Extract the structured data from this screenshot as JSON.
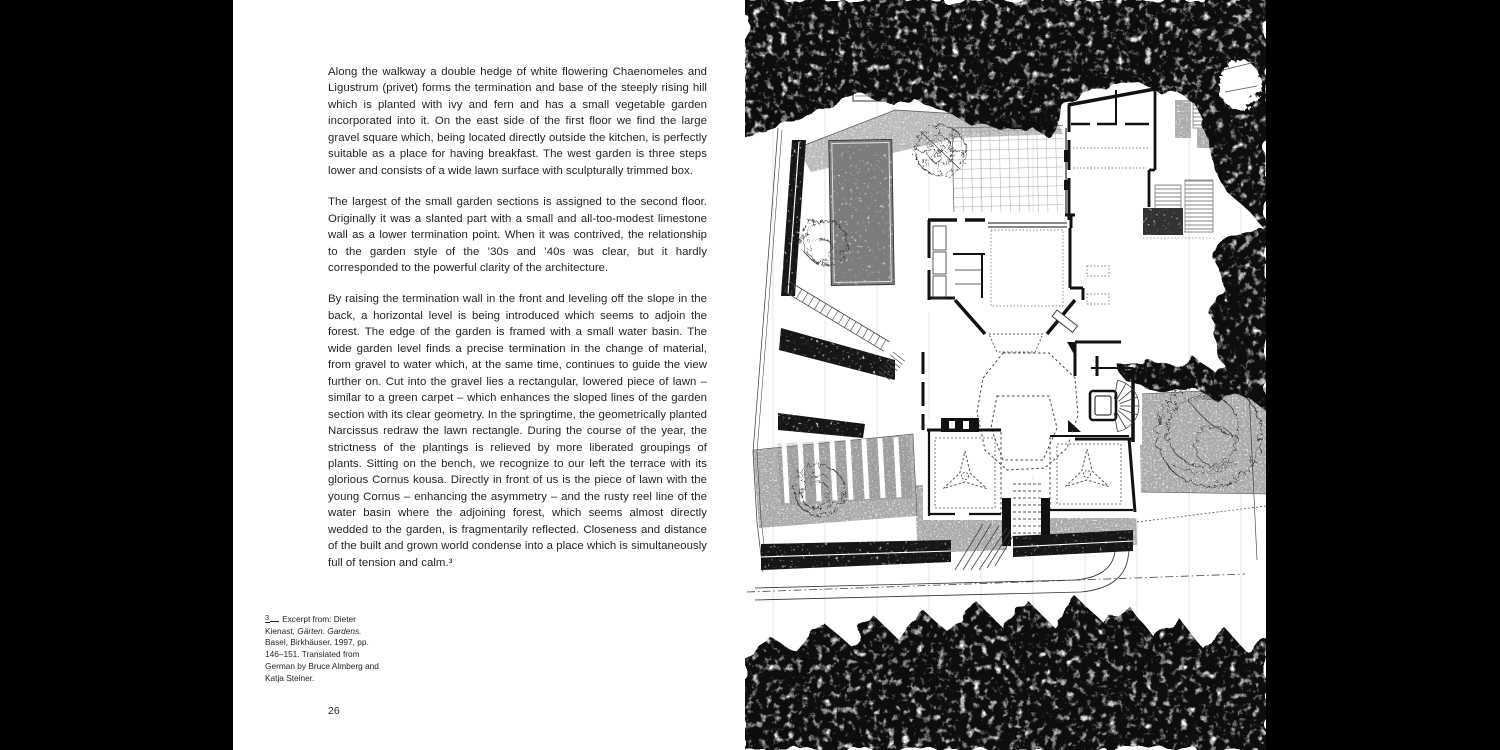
{
  "colors": {
    "background": "#000000",
    "paper": "#ffffff",
    "ink": "#242424"
  },
  "left_page": {
    "paragraphs": [
      "Along the walkway a double hedge of white flowering Chaenomeles and Ligustrum (privet) forms the termination and base of the steeply rising hill which is planted with ivy and fern and has a small vegetable garden incorporated into it. On the east side of the first floor we find the large gravel square which, being located directly outside the kitchen, is perfectly suitable as a place for having breakfast. The west garden is three steps lower and consists of a wide lawn surface with sculpturally trimmed box.",
      "The largest of the small garden sections is assigned to the second floor. Originally it was a slanted part with a small and all-too-modest limestone wall as a lower termination point. When it was contrived, the relationship to the garden style of the ’30s and ’40s was clear, but it hardly corresponded to the powerful clarity of the architecture.",
      "By raising the termination wall in the front and leveling off the slope in the back, a horizontal level is being introduced which seems to adjoin the forest. The edge of the garden is framed with a small water basin. The wide garden level finds a precise termination in the change of material, from gravel to water which, at the same time, continues to guide the view further on. Cut into the gravel lies a rectangular, lowered piece of lawn – similar to a green carpet – which enhances the sloped lines of the garden section with its clear geometry. In the springtime, the geometrically planted Narcissus redraw the lawn rectangle. During the course of the year, the strictness of the plantings is relieved by more liberated groupings of plants. Sitting on the bench, we recognize to our left the terrace with its glorious Cornus kousa. Directly in front of us is the piece of lawn with the young Cornus – enhancing the asymmetry – and the rusty reel line of the water basin where the adjoining forest, which seems almost directly wedded to the garden, is fragmentarily reflected. Closeness and distance of the built and grown world condense into a place which is simultaneously full of tension and calm.³"
    ],
    "footnote": {
      "marker": "3",
      "lead": "Excerpt from: Dieter Kienast, ",
      "work": "Gärten. Gardens.",
      "tail": " Basel, Birkhäuser, 1997, pp. 146–151. Translated from German by Bruce Almberg and Katja Steiner."
    },
    "page_number": "26"
  }
}
